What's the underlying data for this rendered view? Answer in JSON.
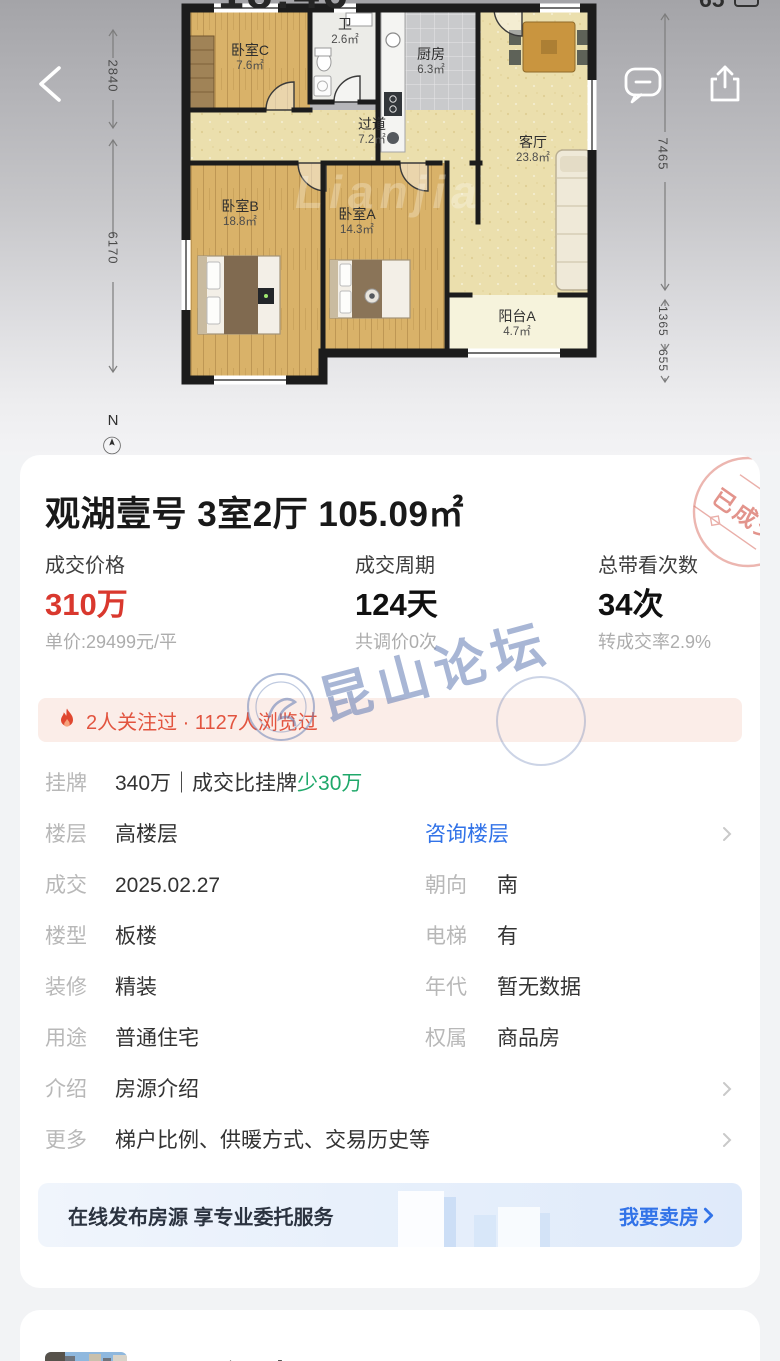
{
  "colors": {
    "accent-red": "#D9382E",
    "accent-green": "#1FA86A",
    "accent-blue": "#3273E8",
    "banner-red": "#E2543F",
    "banner-bg": "#FBEDE8",
    "stamp-red": "#DC7A70",
    "label-gray": "#B8B8B8",
    "text-dark": "#333333",
    "sub-gray": "#ADADAD",
    "watermark-blue": "#6079B4"
  },
  "status_bar": {
    "time": "18:46",
    "battery_percent": "65"
  },
  "floor_plan": {
    "brand_watermark": "Lianjia",
    "north_label": "N",
    "rooms": [
      {
        "name": "卧室C",
        "area": "7.6㎡"
      },
      {
        "name": "卫",
        "area": "2.6㎡"
      },
      {
        "name": "厨房",
        "area": "6.3㎡"
      },
      {
        "name": "过道",
        "area": "7.2㎡"
      },
      {
        "name": "客厅",
        "area": "23.8㎡"
      },
      {
        "name": "卧室B",
        "area": "18.8㎡"
      },
      {
        "name": "卧室A",
        "area": "14.3㎡"
      },
      {
        "name": "阳台A",
        "area": "4.7㎡"
      }
    ],
    "dimensions": {
      "left_top": "2840",
      "left_bottom": "6170",
      "right_top": "7465",
      "right_middle": "1365",
      "right_bottom": "655"
    }
  },
  "listing": {
    "sold_stamp": "已成交",
    "title": "观湖壹号 3室2厅 105.09㎡",
    "stats": [
      {
        "label": "成交价格",
        "value": "310万",
        "sub": "单价:29499元/平"
      },
      {
        "label": "成交周期",
        "value": "124天",
        "sub": "共调价0次"
      },
      {
        "label": "总带看次数",
        "value": "34次",
        "sub": "转成交率2.9%"
      }
    ],
    "hot_banner": "2人关注过 · 1127人浏览过",
    "rows": [
      {
        "label": "挂牌",
        "value": "340万｜成交比挂牌",
        "value_highlight": "少30万"
      },
      {
        "label": "楼层",
        "value": "高楼层",
        "link": "咨询楼层"
      },
      {
        "label": "成交",
        "value": "2025.02.27",
        "label2": "朝向",
        "value2": "南"
      },
      {
        "label": "楼型",
        "value": "板楼",
        "label2": "电梯",
        "value2": "有"
      },
      {
        "label": "装修",
        "value": "精装",
        "label2": "年代",
        "value2": "暂无数据"
      },
      {
        "label": "用途",
        "value": "普通住宅",
        "label2": "权属",
        "value2": "商品房"
      },
      {
        "label": "介绍",
        "value": "房源介绍"
      },
      {
        "label": "更多",
        "value": "梯户比例、供暖方式、交易历史等"
      }
    ],
    "sell_banner": {
      "text": "在线发布房源 享专业委托服务",
      "action": "我要卖房"
    }
  },
  "site_watermark": "昆山论坛",
  "next_listing": {
    "title": "观湖壹号"
  }
}
